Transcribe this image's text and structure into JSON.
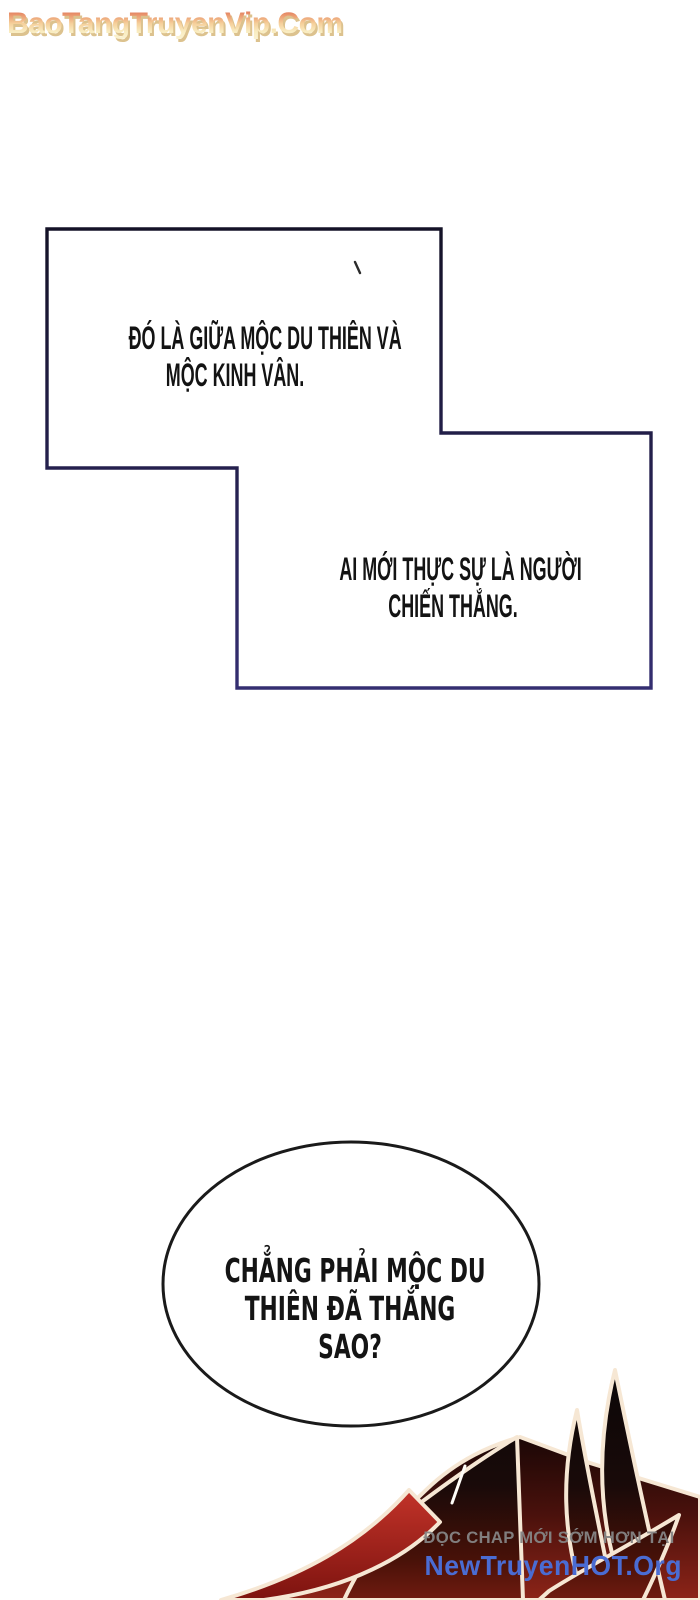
{
  "watermark_top": {
    "text": "BaoTangTruyenVip.Com"
  },
  "speech": {
    "box1": {
      "line1": "ĐÓ LÀ GIỮA MỘC DU THIÊN VÀ",
      "line2": "MỘC KINH VÂN."
    },
    "box2": {
      "line1": "AI MỚI THỰC SỰ LÀ NGƯỜI",
      "line2": "CHIẾN THẮNG."
    },
    "bubble": {
      "line1": "CHẲNG PHẢI MỘC DU",
      "line2": "THIÊN ĐÃ THẮNG",
      "line3": "SAO?"
    }
  },
  "watermark_bottom": {
    "line1": "ĐỌC CHAP MỚI SỚM HƠN TẠI",
    "line2": "NewTruyenHOT.Org"
  },
  "colors": {
    "page_background": "#ffffff",
    "panel_border_top": "#141227",
    "panel_border_bottom": "#342e71",
    "bubble_border": "#1a1a1a",
    "text_black": "#131313",
    "watermark_top_red": "#d8604b",
    "watermark_top_cream": "#fbf4d6",
    "watermark_top_shadow": "#dcc28e",
    "watermark_bottom_gray": "#858585",
    "watermark_bottom_blue": "#4a6cd3",
    "art_black": "#0b0708",
    "art_dark_red": "#701b10",
    "art_bright_red": "#c23329",
    "art_glow_cream": "#f6e7d4"
  }
}
